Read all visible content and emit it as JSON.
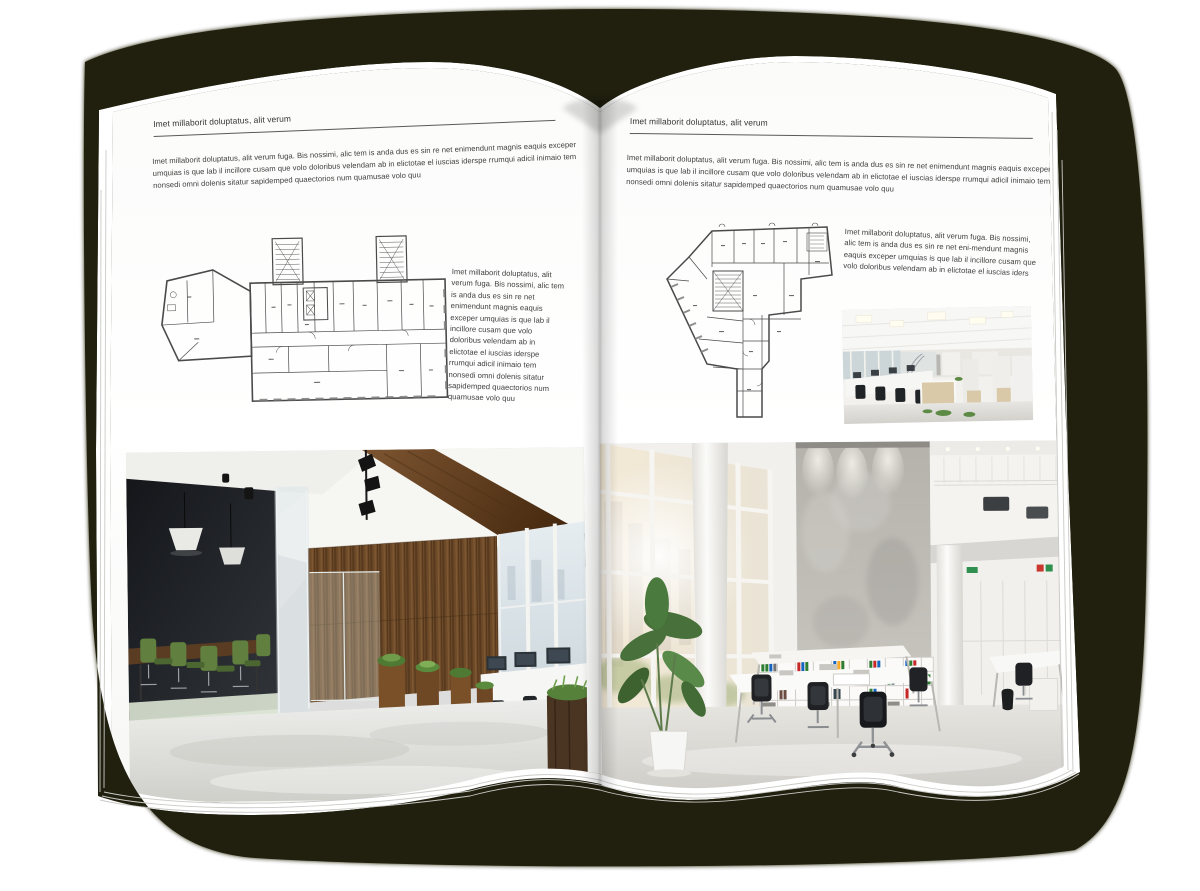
{
  "palette": {
    "background": "#ffffff",
    "cover": "#21200f",
    "page": "#ffffff",
    "text": "#3d3d3d",
    "rule_line": "#5a5a5a",
    "plan_line": "#4a4a4a",
    "chair_green": "#61803f",
    "wood": "#6e4a29"
  },
  "left_page": {
    "header": "Imet millaborit doluptatus, alit verum",
    "intro": "Imet millaborit doluptatus, alit verum fuga. Bis nossimi, alic tem is anda dus es sin re net enimendunt magnis eaquis exceper umquias is que lab il incillore cusam que volo doloribus velendam ab in elictotae el iuscias iderspe rrumqui adicil inimaio tem nonsedi omni dolenis sitatur sapidemped quaectorios num quamusae volo quu",
    "plan_caption": "Imet millaborit doluptatus, alit verum fuga. Bis nossimi, alic tem is anda dus es sin re net enimendunt magnis eaquis exceper umquias is que lab il incillore cusam que volo doloribus velendam ab in elictotae el iuscias iderspe rrumqui adicil inimaio tem nonsedi omni dolenis sitatur sapidemped quaectorios num quamusae volo quu"
  },
  "right_page": {
    "header": "Imet millaborit doluptatus, alit verum",
    "intro": "Imet millaborit doluptatus, alit verum fuga. Bis nossimi, alic tem is anda dus es sin re net enimendunt magnis eaquis exceper umquias is que lab il incillore cusam que volo doloribus velendam ab in elictotae el iuscias iderspe rrumqui adicil inimaio tem nonsedi omni dolenis sitatur sapidemped quaectorios num quamusae volo quu",
    "plan_caption": "Imet millaborit doluptatus, alit verum fuga. Bis nossimi, alic tem is anda dus es sin re net eni-mendunt magnis eaquis exceper umquias is que lab il incillore cusam que volo doloribus velendam ab in elictotae el iuscias iders"
  }
}
